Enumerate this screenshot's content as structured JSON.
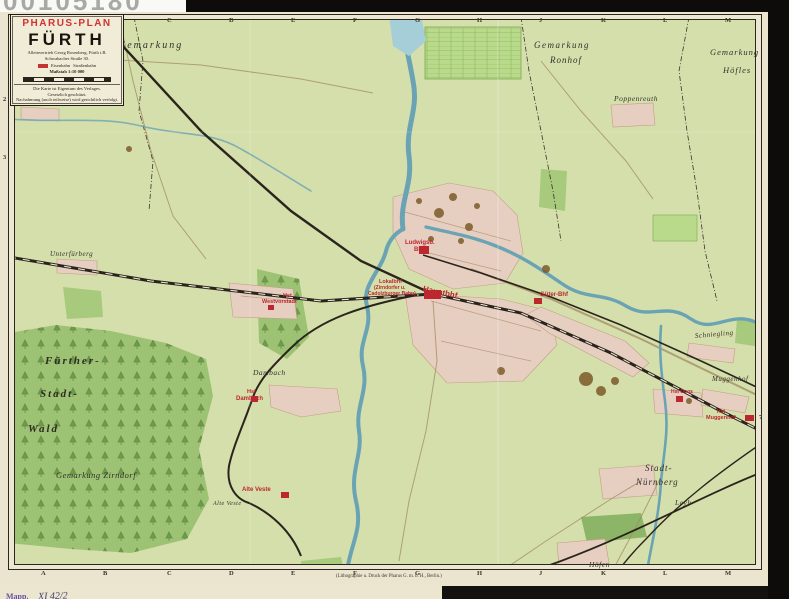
{
  "scan": {
    "number": "00105180"
  },
  "title_box": {
    "brand": "PHARUS-PLAN",
    "city": "FÜRTH",
    "line1": "Alleinvertrieb Georg Rosenberg, Fürth i.B.",
    "line2": "Schwabacher Straße 30.",
    "legend_left": "Eisenbahn",
    "legend_right": "Straßenbahn",
    "scale_label": "Maßstab 1:10 000",
    "note1": "Die Karte ist Eigentum des Verlages.",
    "note2": "Gesetzlich geschützt.",
    "note3": "Nachahmung (auch teilweise) wird gerichtlich verfolgt."
  },
  "stamp": {
    "prefix": "Mapp.",
    "number": "XI 42/2"
  },
  "imprint": "(Lithographie u. Druck der Pharus G. m. b. H., Berlin.)",
  "colors": {
    "station_red": "#bc2730",
    "map_green": "#d5dfab",
    "forest_green": "#9dc273",
    "water_blue": "#6aa4b4",
    "built_pink": "#e6cfc0",
    "rail_black": "#2b241d"
  },
  "grid": {
    "top_letters": [
      {
        "t": "A",
        "x": 41,
        "y": 84
      },
      {
        "t": "B",
        "x": 103,
        "y": 84
      },
      {
        "t": "C",
        "x": 167,
        "y": 17
      },
      {
        "t": "D",
        "x": 229,
        "y": 17
      },
      {
        "t": "E",
        "x": 291,
        "y": 17
      },
      {
        "t": "F",
        "x": 353,
        "y": 17
      },
      {
        "t": "G",
        "x": 415,
        "y": 17
      },
      {
        "t": "H",
        "x": 477,
        "y": 17
      },
      {
        "t": "J",
        "x": 539,
        "y": 17
      },
      {
        "t": "K",
        "x": 601,
        "y": 17
      },
      {
        "t": "L",
        "x": 663,
        "y": 17
      },
      {
        "t": "M",
        "x": 725,
        "y": 17
      }
    ],
    "bottom_letters": [
      {
        "t": "A",
        "x": 41,
        "y": 570
      },
      {
        "t": "B",
        "x": 103,
        "y": 570
      },
      {
        "t": "C",
        "x": 167,
        "y": 570
      },
      {
        "t": "D",
        "x": 229,
        "y": 570
      },
      {
        "t": "E",
        "x": 291,
        "y": 570
      },
      {
        "t": "F",
        "x": 353,
        "y": 570
      },
      {
        "t": "G",
        "x": 415,
        "y": 570
      },
      {
        "t": "H",
        "x": 477,
        "y": 570
      },
      {
        "t": "J",
        "x": 539,
        "y": 570
      },
      {
        "t": "K",
        "x": 601,
        "y": 570
      },
      {
        "t": "L",
        "x": 663,
        "y": 570
      },
      {
        "t": "M",
        "x": 725,
        "y": 570
      }
    ],
    "left_numbers": [
      {
        "t": "2",
        "x": 3,
        "y": 96
      },
      {
        "t": "3",
        "x": 3,
        "y": 154
      }
    ],
    "right_numbers": [
      {
        "t": "7",
        "x": 759,
        "y": 414
      }
    ]
  },
  "map": {
    "labels": [
      {
        "name": "label-gemarkung-nw",
        "t": "Gemarkung",
        "x": 118,
        "y": 40,
        "cls": "blk",
        "s": 10,
        "sp": 2
      },
      {
        "name": "label-unterfarrnbach",
        "t": "Unterfarrnbach",
        "x": 24,
        "y": 96,
        "cls": "blk",
        "s": 9,
        "sp": 1
      },
      {
        "name": "label-gemarkung-ronhof-1",
        "t": "Gemarkung",
        "x": 534,
        "y": 40,
        "cls": "blk",
        "s": 9,
        "sp": 1.5
      },
      {
        "name": "label-gemarkung-ronhof-2",
        "t": "Ronhof",
        "x": 550,
        "y": 55,
        "cls": "blk",
        "s": 9,
        "sp": 1
      },
      {
        "name": "label-gemarkung-hoefles-1",
        "t": "Gemarkung",
        "x": 710,
        "y": 47,
        "cls": "blk",
        "s": 8.5,
        "sp": 1
      },
      {
        "name": "label-gemarkung-hoefles-2",
        "t": "Höfles",
        "x": 723,
        "y": 65,
        "cls": "blk",
        "s": 8.5,
        "sp": 1
      },
      {
        "name": "label-poppenreuth",
        "t": "Poppenreuth",
        "x": 614,
        "y": 94,
        "cls": "blk",
        "s": 7.5
      },
      {
        "name": "label-unterfuerberg",
        "t": "Unterfürberg",
        "x": 50,
        "y": 250,
        "cls": "blk",
        "s": 7
      },
      {
        "name": "label-fuerther",
        "t": "Fürther-",
        "x": 45,
        "y": 355,
        "cls": "blk-big",
        "s": 11,
        "sp": 2
      },
      {
        "name": "label-stadt",
        "t": "Stadt-",
        "x": 40,
        "y": 388,
        "cls": "blk-big",
        "s": 11,
        "sp": 2
      },
      {
        "name": "label-wald",
        "t": "Wald",
        "x": 28,
        "y": 423,
        "cls": "blk-big",
        "s": 11,
        "sp": 2
      },
      {
        "name": "label-gemarkung-zirndorf",
        "t": "Gemarkung Zirndorf",
        "x": 56,
        "y": 470,
        "cls": "blk",
        "s": 8.5
      },
      {
        "name": "label-dambach-village",
        "t": "Dambach",
        "x": 253,
        "y": 368,
        "cls": "blk",
        "s": 7.5
      },
      {
        "name": "label-schniegling",
        "t": "Schniegling",
        "x": 695,
        "y": 332,
        "cls": "blk",
        "s": 7,
        "rot": -5
      },
      {
        "name": "label-muggenhof-village",
        "t": "Muggenhof",
        "x": 712,
        "y": 375,
        "cls": "blk",
        "s": 7
      },
      {
        "name": "label-stadt-nuernberg-1",
        "t": "Stadt-",
        "x": 645,
        "y": 463,
        "cls": "blk",
        "s": 9,
        "sp": 1
      },
      {
        "name": "label-stadt-nuernberg-2",
        "t": "Nürnberg",
        "x": 636,
        "y": 477,
        "cls": "blk",
        "s": 9,
        "sp": 1
      },
      {
        "name": "label-leyh",
        "t": "Leyh",
        "x": 675,
        "y": 498,
        "cls": "blk",
        "s": 7.5
      },
      {
        "name": "label-hoefen",
        "t": "Höfen",
        "x": 589,
        "y": 560,
        "cls": "blk",
        "s": 7.5
      },
      {
        "name": "label-alte-veste-hill",
        "t": "Alte Veste",
        "x": 213,
        "y": 501,
        "cls": "blk",
        "s": 6
      },
      {
        "name": "label-ludwigsbahn-bhf-1",
        "t": "Ludwigsb.",
        "x": 405,
        "y": 240,
        "cls": "red",
        "s": 6
      },
      {
        "name": "label-ludwigsbahn-bhf-2",
        "t": "Bhf",
        "x": 414,
        "y": 247,
        "cls": "red",
        "s": 6
      },
      {
        "name": "label-lokalbhf-1",
        "t": "Lokalbhf",
        "x": 379,
        "y": 279,
        "cls": "red",
        "s": 5.5
      },
      {
        "name": "label-lokalbhf-2",
        "t": "(Zirndorfer u.",
        "x": 374,
        "y": 285,
        "cls": "red",
        "s": 5
      },
      {
        "name": "label-lokalbhf-3",
        "t": "Cadolzburger Bahn)",
        "x": 368,
        "y": 291,
        "cls": "red",
        "s": 5
      },
      {
        "name": "label-hauptbhf",
        "t": "Hauptbhf.",
        "x": 423,
        "y": 284,
        "cls": "red-bold",
        "s": 8,
        "rot": 12
      },
      {
        "name": "label-gueter-bhf",
        "t": "Güter-Bhf",
        "x": 540,
        "y": 292,
        "cls": "red",
        "s": 6
      },
      {
        "name": "label-hst-westvorstadt-1",
        "t": "Hst",
        "x": 283,
        "y": 293,
        "cls": "red",
        "s": 5.5
      },
      {
        "name": "label-hst-westvorstadt-2",
        "t": "Westvorstadt",
        "x": 262,
        "y": 299,
        "cls": "red",
        "s": 5.5
      },
      {
        "name": "label-hst-dambach-1",
        "t": "Hst",
        "x": 247,
        "y": 389,
        "cls": "red",
        "s": 5.5
      },
      {
        "name": "label-hst-dambach-2",
        "t": "Dambach",
        "x": 236,
        "y": 396,
        "cls": "red",
        "s": 6
      },
      {
        "name": "label-alte-veste-station",
        "t": "Alte Veste",
        "x": 242,
        "y": 487,
        "cls": "red",
        "s": 6
      },
      {
        "name": "label-hst-doos",
        "t": "Hst Doos",
        "x": 671,
        "y": 389,
        "cls": "red",
        "s": 5
      },
      {
        "name": "label-hst-muggenhof-1",
        "t": "Hst",
        "x": 717,
        "y": 409,
        "cls": "red",
        "s": 5
      },
      {
        "name": "label-hst-muggenhof-2",
        "t": "Muggenhof",
        "x": 706,
        "y": 415,
        "cls": "red",
        "s": 5.5
      }
    ]
  }
}
